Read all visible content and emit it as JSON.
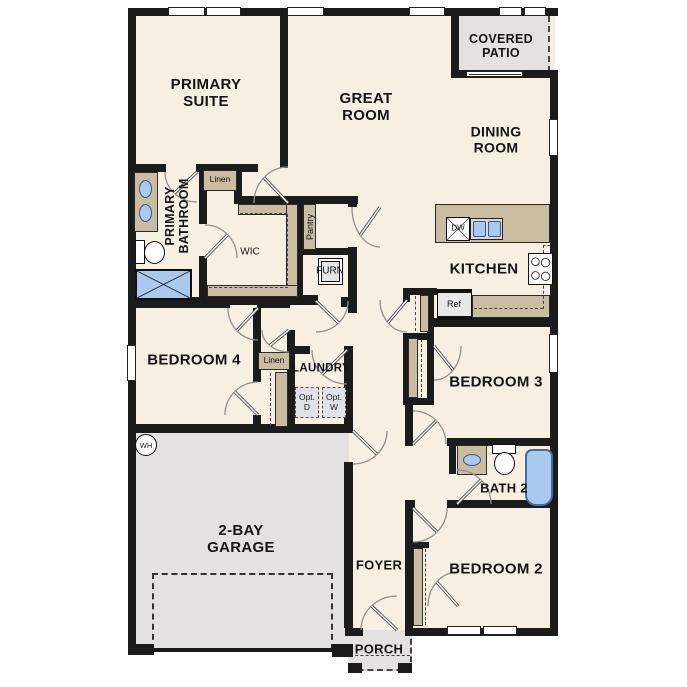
{
  "plan_title": "floor-plan",
  "labels": {
    "primary_suite": "PRIMARY SUITE",
    "great_room": "GREAT ROOM",
    "covered_patio": "COVERED PATIO",
    "dining_room": "DINING ROOM",
    "primary_bathroom": "PRIMARY BATHROOM",
    "linen_primary": "Linen",
    "linen_hall": "Linen",
    "wic": "WIC",
    "pantry": "Pantry",
    "furn": "FURN",
    "kitchen": "KITCHEN",
    "dw": "DW",
    "ref": "Ref",
    "bedroom4": "BEDROOM 4",
    "laundry": "LAUNDRY",
    "opt_dryer": "Opt. D",
    "opt_washer": "Opt. W",
    "bedroom3": "BEDROOM 3",
    "bath2": "BATH 2",
    "bedroom2": "BEDROOM 2",
    "garage": "2-BAY GARAGE",
    "foyer": "FOYER",
    "porch": "PORCH",
    "water_heater": "WH"
  },
  "colors": {
    "floor": "#f7efe2",
    "casework": "#c9bca1",
    "concrete": "#e3e2e0",
    "fixture_blue": "#aac9ee",
    "wall": "#1b1b1b"
  }
}
